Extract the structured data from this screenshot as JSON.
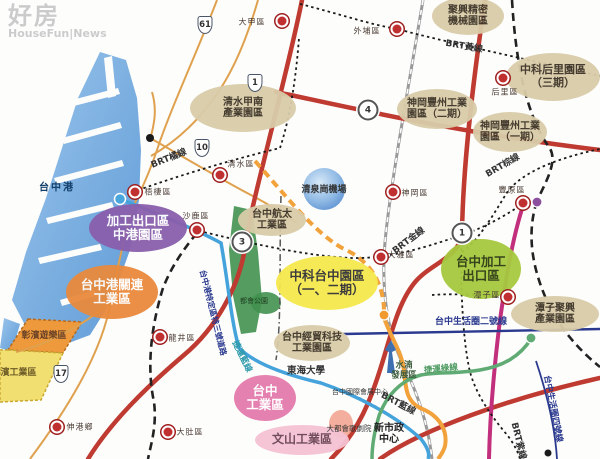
{
  "watermark": {
    "brand": "好房",
    "suffix": "HouseFun|News"
  },
  "map_labels": {
    "port": "台中港",
    "airport": "清泉崗機場",
    "metro_park": "都會公園",
    "shuinan": "水湳\n發展區",
    "university": "東海大學",
    "expo_center": "台中國際會展中心",
    "opera_house": "大都會歌劇院",
    "city_hall": "新市政\n中心",
    "changbin_fun": "彰濱遊樂區",
    "changbin_ind": "彰濱工業區"
  },
  "zones": [
    {
      "label": "清水甲南\n產業園區"
    },
    {
      "label": "聚興精密\n機械園區"
    },
    {
      "label": "中科后里園區\n（三期）"
    },
    {
      "label": "神岡豐州工業\n園區（二期）"
    },
    {
      "label": "神岡豐州工業\n園區（一期）"
    },
    {
      "label": "台中航太\n工業區"
    },
    {
      "label": "加工出口區\n中港園區"
    },
    {
      "label": "台中港關連\n工業區"
    },
    {
      "label": "中科台中園區\n（一、二期）"
    },
    {
      "label": "台中經貿科技\n工業園區"
    },
    {
      "label": "台中加工\n出口區"
    },
    {
      "label": "潭子聚興\n產業園區"
    },
    {
      "label": "台中\n工業區"
    },
    {
      "label": "文山工業區"
    }
  ],
  "districts": [
    {
      "name": "大甲區"
    },
    {
      "name": "外埔區"
    },
    {
      "name": "后里區"
    },
    {
      "name": "清水區"
    },
    {
      "name": "梧棲區"
    },
    {
      "name": "沙鹿區"
    },
    {
      "name": "神岡區"
    },
    {
      "name": "大雅區"
    },
    {
      "name": "豐原區"
    },
    {
      "name": "潭子區"
    },
    {
      "name": "龍井區"
    },
    {
      "name": "大肚區"
    },
    {
      "name": "伸港鄉"
    }
  ],
  "shields": [
    {
      "num": "61"
    },
    {
      "num": "1"
    },
    {
      "num": "4"
    },
    {
      "num": "10"
    },
    {
      "num": "3"
    },
    {
      "num": "1"
    },
    {
      "num": "17"
    }
  ],
  "transit": [
    {
      "label": "BRT黃線"
    },
    {
      "label": "BRT橘線"
    },
    {
      "label": "BRT金線"
    },
    {
      "label": "BRT棕線"
    },
    {
      "label": "BRT藍線"
    },
    {
      "label": "BRT紫線"
    },
    {
      "label": "捷運藍線"
    },
    {
      "label": "捷運綠線"
    }
  ],
  "corridors": [
    {
      "label": "台中生活圈二號線"
    },
    {
      "label": "台中生活圈四號線"
    },
    {
      "label": "台中港特定區特三號道路"
    }
  ],
  "colors": {
    "zone_beige": "#D9CCA9",
    "zone_purple": "#8A5FAC",
    "zone_orange": "#E98A3C",
    "zone_yellow": "#F6E84E",
    "zone_green": "#A6C93F",
    "zone_pink": "#E47BAC",
    "zone_lightpink": "#F5C3D4",
    "highway_red": "#BF3A31",
    "expressway_magenta": "#C22F7C",
    "mrt_blue": "#45A3DC",
    "mrt_green": "#5FAB73",
    "road_tan": "#DFA14E",
    "road_orange": "#F2A23B",
    "corridor_navy": "#2B3A8F",
    "district_marker": "#C03030",
    "water": "#7FB5E3"
  }
}
